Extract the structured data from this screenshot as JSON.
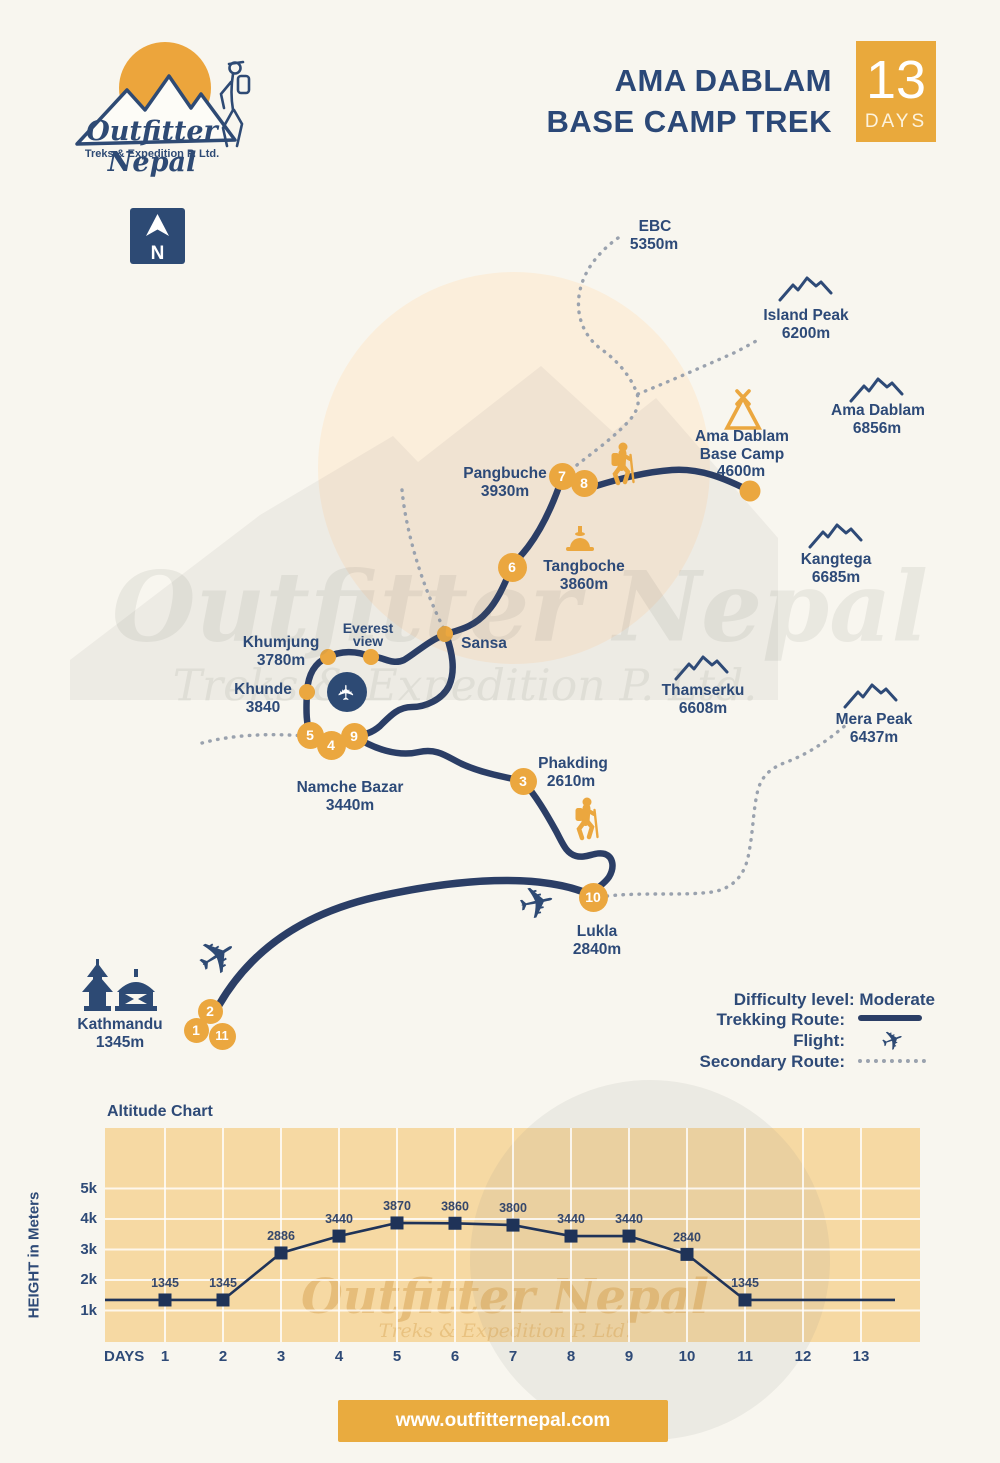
{
  "header": {
    "logo": {
      "brand": "Outfitter Nepal",
      "tagline": "Treks & Expedition P. Ltd."
    },
    "title_line1": "AMA DABLAM",
    "title_line2": "BASE CAMP TREK",
    "days_number": "13",
    "days_label": "DAYS"
  },
  "map": {
    "north": "N",
    "watermark_line1": "Outfitter Nepal",
    "watermark_line2": "Treks & Expedition P. Ltd.",
    "places": {
      "ebc": {
        "name": "EBC",
        "elev": "5350m"
      },
      "adbc": {
        "line1": "Ama Dablam",
        "line2": "Base Camp",
        "elev": "4600m"
      },
      "pangbuche": {
        "name": "Pangbuche",
        "elev": "3930m"
      },
      "tangboche": {
        "name": "Tangboche",
        "elev": "3860m"
      },
      "sansa": {
        "name": "Sansa"
      },
      "everest_view": {
        "line1": "Everest",
        "line2": "view"
      },
      "khumjung": {
        "name": "Khumjung",
        "elev": "3780m"
      },
      "khunde": {
        "name": "Khunde",
        "elev": "3840"
      },
      "namche": {
        "name": "Namche Bazar",
        "elev": "3440m"
      },
      "phakding": {
        "name": "Phakding",
        "elev": "2610m"
      },
      "lukla": {
        "name": "Lukla",
        "elev": "2840m"
      },
      "kathmandu": {
        "name": "Kathmandu",
        "elev": "1345m"
      }
    },
    "peaks": {
      "island": {
        "name": "Island Peak",
        "elev": "6200m"
      },
      "ama_dablam": {
        "name": "Ama Dablam",
        "elev": "6856m"
      },
      "kangtega": {
        "name": "Kangtega",
        "elev": "6685m"
      },
      "thamserku": {
        "name": "Thamserku",
        "elev": "6608m"
      },
      "mera": {
        "name": "Mera Peak",
        "elev": "6437m"
      }
    },
    "waypoints": [
      "1",
      "2",
      "3",
      "4",
      "5",
      "6",
      "7",
      "8",
      "9",
      "10",
      "11"
    ]
  },
  "legend": {
    "difficulty": "Difficulty level: Moderate",
    "trekking": "Trekking Route:",
    "flight": "Flight:",
    "secondary": "Secondary Route:"
  },
  "chart": {
    "title": "Altitude Chart",
    "y_axis_title": "HEIGHT in Meters",
    "x_axis_title": "DAYS"
  },
  "chart_data": {
    "type": "line",
    "title": "Altitude Chart",
    "xlabel": "DAYS",
    "ylabel": "HEIGHT in Meters",
    "days": [
      1,
      2,
      3,
      4,
      5,
      6,
      7,
      8,
      9,
      10,
      11,
      12,
      13
    ],
    "values": [
      1345,
      1345,
      2886,
      3440,
      3870,
      3860,
      3800,
      3440,
      3440,
      2840,
      1345
    ],
    "value_labels": [
      "1345",
      "1345",
      "2886",
      "3440",
      "3870",
      "3860",
      "3800",
      "3440",
      "3440",
      "2840",
      "1345"
    ],
    "y_ticks": [
      "1k",
      "2k",
      "3k",
      "4k",
      "5k"
    ],
    "y_range_m": [
      0,
      6500
    ],
    "marker": "square",
    "grid": true,
    "line_extends_flat_left_and_right": true
  },
  "footer": {
    "url": "www.outfitternepal.com"
  }
}
